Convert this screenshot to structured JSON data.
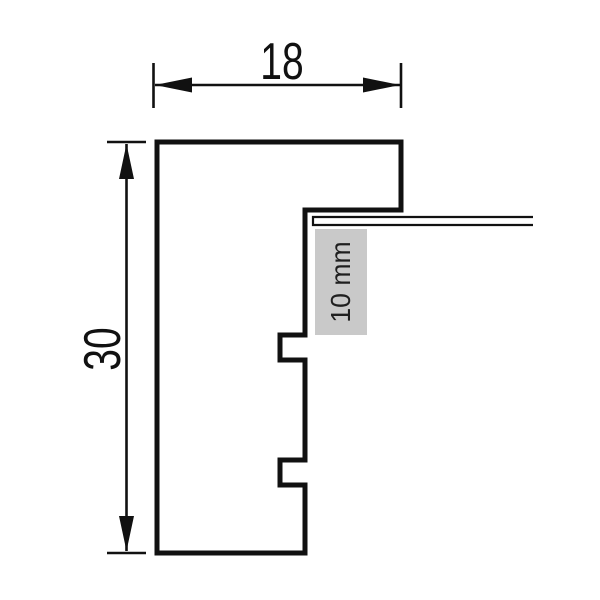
{
  "diagram": {
    "type": "technical-cross-section-profile",
    "background_color": "#ffffff",
    "line_color": "#111111",
    "labels": {
      "width_dimension": "18",
      "height_dimension": "30",
      "rabbet_depth": "10 mm"
    },
    "label_box_color": "#c9c9c9",
    "label_text_color": "#1f1f1f",
    "geometry": {
      "profile_outline": "M 157 142 L 401 142 L 401 210 L 305 210 L 305 335 L 280 335 L 280 360 L 305 360 L 305 460 L 280 460 L 280 485 L 305 485 L 305 553 L 157 553 Z",
      "glass_panel": "M 533 217 L 313 217 L 313 225 L 533 225",
      "rabbet_label_box": "M 315 229 L 367 229 L 367 335 L 315 335 Z",
      "width_dim_lines": "M 153.5 63 L 153.5 108 M 401 63 L 401 108 M 155 85 L 400 85",
      "width_dim_arrows": "M 155 85 L 192 77.5 L 192 92.5 Z M 400 85 L 363 77.5 L 363 92.5 Z",
      "height_dim_lines": "M 107 142 L 146 142 M 107 553 L 146 553 M 126.5 144 L 126.5 551",
      "height_dim_arrows": "M 126.5 144 L 119 179 L 134 179 Z M 126.5 551 L 119 516 L 134 516 Z"
    }
  }
}
